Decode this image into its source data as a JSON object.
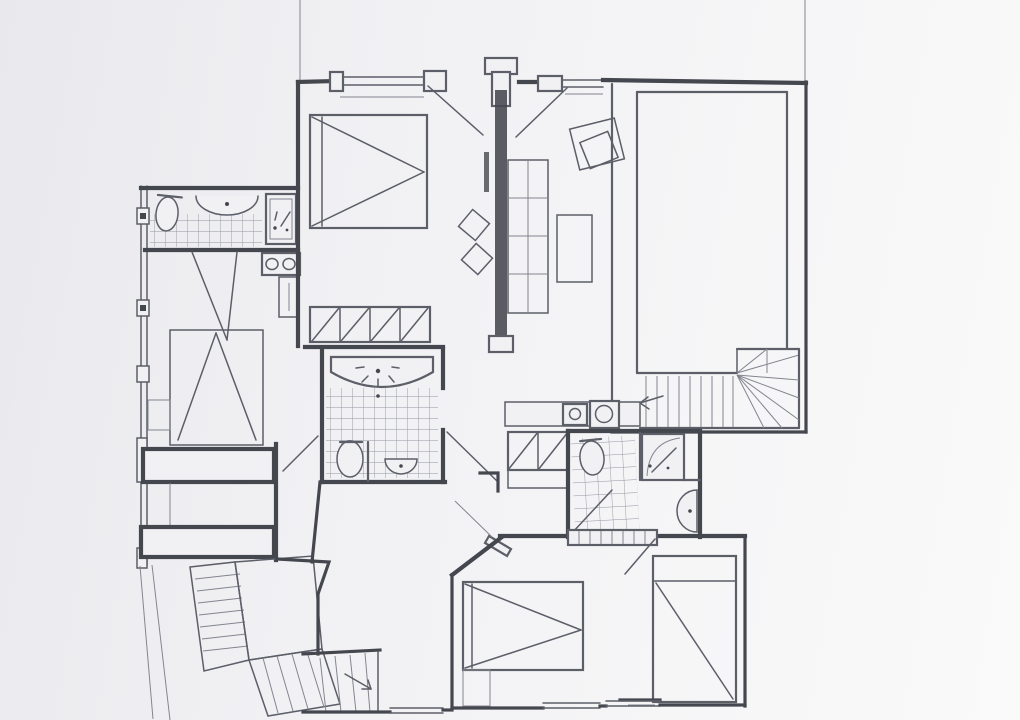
{
  "artwork": {
    "kind": "hand-drawn apartment floor plan sketch",
    "medium": "ink and pencil on white paper",
    "visible_text": "",
    "orientation": "plan view"
  },
  "palette": {
    "paper": "#f1f1f4",
    "paper-lite": "#fafafa",
    "paper-dark": "#e9e9ed",
    "ink": "#45474f",
    "ink2": "#5c5e68",
    "ink3": "#83858f",
    "tile": "#9295a1"
  },
  "inventory": {
    "rooms": [
      "top-left bathroom with tiled floor",
      "kitchen corner with stove and counter",
      "top-left bedroom",
      "left bedroom with bed against window wall",
      "central bathroom with fan-shaped vanity",
      "living room with shelving, table and armchair",
      "large right room with winder staircase",
      "right bathroom with shower and basin niche",
      "bottom bedroom with bed and wardrobe",
      "entry hall with closets and laundry counter",
      "exterior staircase with landing (bottom left)",
      "interior stair run (bottom centre)"
    ],
    "fixtures": [
      "toilet (3)",
      "wash basin (4)",
      "shower cabin",
      "appliance with sparkle mark",
      "stove with two burners",
      "washing machine and sink counter",
      "bed (4)",
      "wardrobe with diagonal marks (3)",
      "shelf unit 2x4",
      "table",
      "armchair (rotated squares)",
      "stool (2)",
      "radiator (hatched)",
      "door swings",
      "direction arrows on stairs",
      "windows with mullion blocks"
    ]
  }
}
